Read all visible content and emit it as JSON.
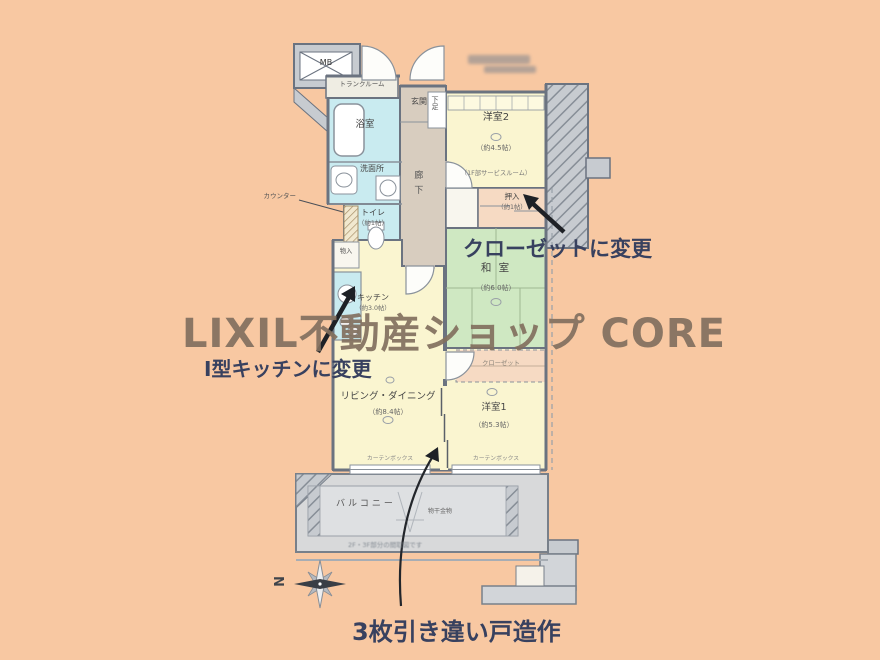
{
  "watermark": {
    "text": "LIXIL不動産ショップ CORE",
    "color": "#82705f"
  },
  "annotations": {
    "closet_change": "クローゼットに変更",
    "kitchen_change": "Ⅰ型キッチンに変更",
    "sliding_door": "3枚引き違い戸造作",
    "color": "#38415f"
  },
  "compass": {
    "north": "N"
  },
  "plan": {
    "mb": "MB",
    "trunk_room": "トランクルーム",
    "bath": "浴室",
    "washroom": "洗面所",
    "toilet": "トイレ",
    "toilet_size": "（約1帖）",
    "counter": "カウンター",
    "entrance": "玄関",
    "shoe_box": "下足",
    "corridor": "廊下",
    "room2": "洋室2",
    "room2_size": "（約4.5帖）",
    "room2_note": "（1F部サービスルーム）",
    "oshiire": "押入",
    "oshiire_size": "（約1帖）",
    "washitsu": "和 室",
    "washitsu_size": "（約6.0帖）",
    "storage": "物入",
    "kitchen": "キッチン",
    "kitchen_size": "（約3.0帖）",
    "living": "リビング・ダイニング",
    "living_size": "（約8.4帖）",
    "room1": "洋室1",
    "room1_size": "（約5.3帖）",
    "closet": "クローゼット",
    "balcony": "バルコニー",
    "laundry_hardware": "物干金物",
    "curtain_box": "カーテンボックス",
    "floor_note": "2F・3F部分の間取図です"
  },
  "colors": {
    "background": "#f8c8a2",
    "room_yellow": "#faf5d0",
    "wet_cyan": "#c9ebf0",
    "tatami_green": "#cfe8c2",
    "corridor_tan": "#d8cdbf",
    "closet_peach": "#f6dac3",
    "structure_gray": "#c7cbd0"
  }
}
